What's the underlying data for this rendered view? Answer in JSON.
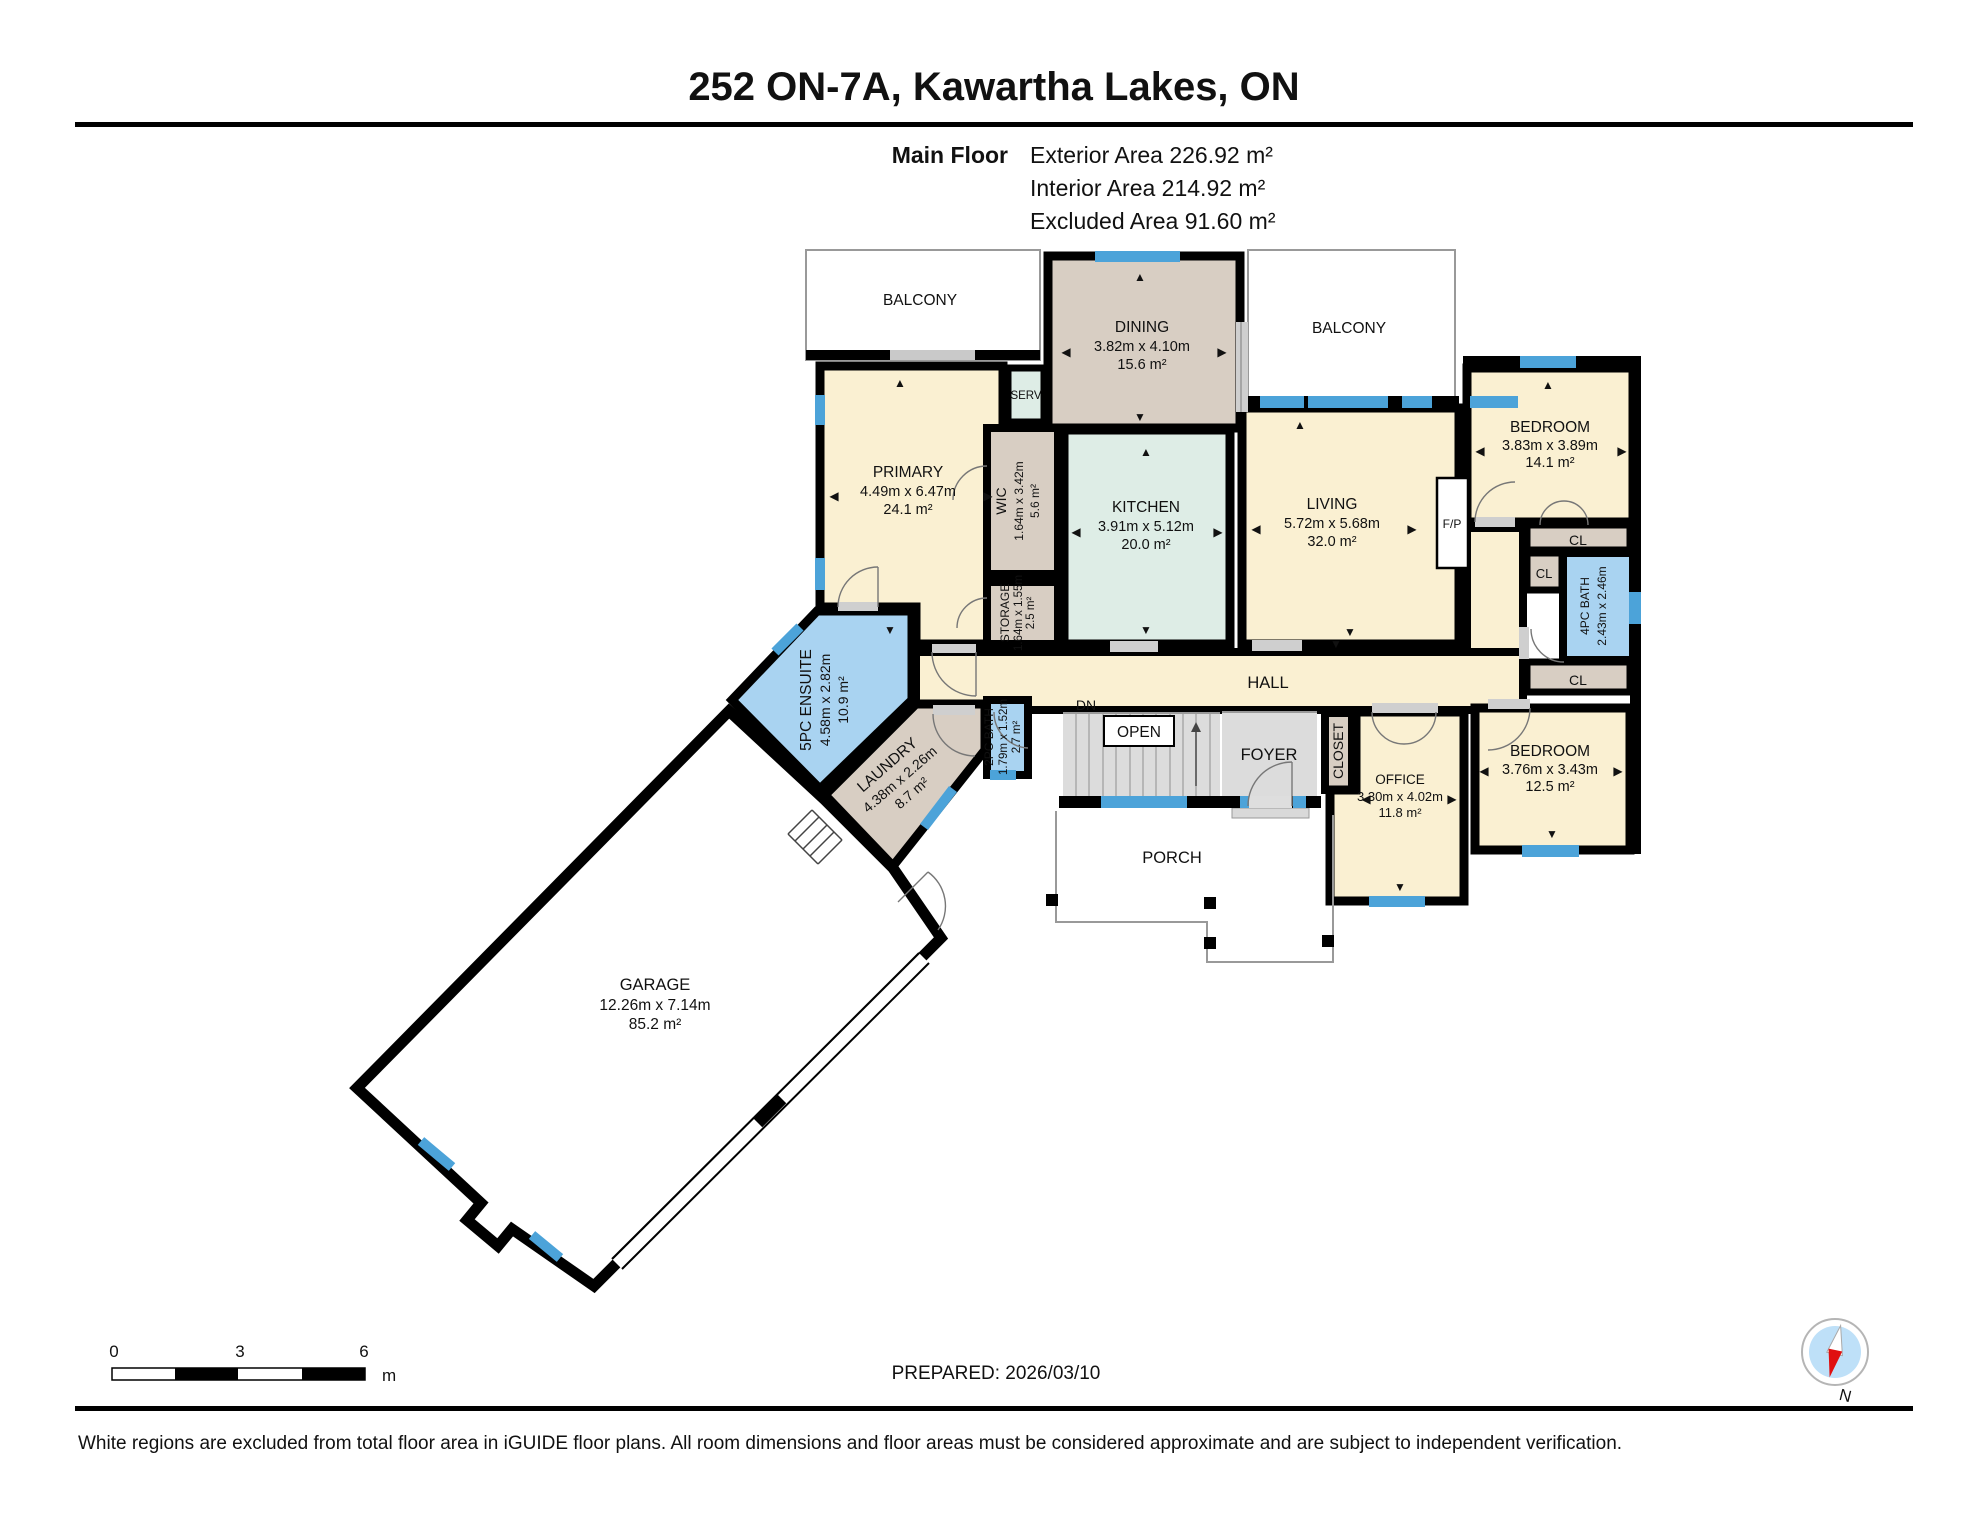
{
  "header": {
    "title": "252 ON-7A, Kawartha Lakes, ON",
    "floor_label": "Main Floor",
    "stats": {
      "exterior": "Exterior Area 226.92 m²",
      "interior": "Interior Area 214.92 m²",
      "excluded": "Excluded Area 91.60 m²"
    }
  },
  "rooms": {
    "balcony1": {
      "name": "BALCONY"
    },
    "balcony2": {
      "name": "BALCONY"
    },
    "dining": {
      "name": "DINING",
      "dims": "3.82m x 4.10m",
      "area": "15.6 m²"
    },
    "bedroom_tr": {
      "name": "BEDROOM",
      "dims": "3.83m x 3.89m",
      "area": "14.1 m²"
    },
    "primary": {
      "name": "PRIMARY",
      "dims": "4.49m x 6.47m",
      "area": "24.1 m²"
    },
    "serv": {
      "name": "SERV"
    },
    "wic": {
      "name": "WIC",
      "dims": "1.64m x 3.42m",
      "area": "5.6 m²"
    },
    "storage": {
      "name": "STORAGE",
      "dims": "1.64m x 1.55m",
      "area": "2.5 m²"
    },
    "kitchen": {
      "name": "KITCHEN",
      "dims": "3.91m x 5.12m",
      "area": "20.0 m²"
    },
    "living": {
      "name": "LIVING",
      "dims": "5.72m x 5.68m",
      "area": "32.0 m²"
    },
    "fp": {
      "name": "F/P"
    },
    "hall": {
      "name": "HALL"
    },
    "dn": {
      "name": "DN"
    },
    "open": {
      "name": "OPEN"
    },
    "foyer": {
      "name": "FOYER"
    },
    "closet": {
      "name": "CLOSET"
    },
    "office": {
      "name": "OFFICE",
      "dims": "3.30m x 4.02m",
      "area": "11.8 m²"
    },
    "bedroom_br": {
      "name": "BEDROOM",
      "dims": "3.76m x 3.43m",
      "area": "12.5 m²"
    },
    "porch": {
      "name": "PORCH"
    },
    "ensuite": {
      "name": "5PC ENSUITE",
      "dims": "4.58m x 2.82m",
      "area": "10.9 m²"
    },
    "laundry": {
      "name": "LAUNDRY",
      "dims": "4.38m x 2.26m",
      "area": "8.7 m²"
    },
    "bath2": {
      "name": "2PC BATH",
      "dims": "1.79m x 1.52m",
      "area": "2.7 m²"
    },
    "bath4": {
      "name": "4PC BATH",
      "dims": "2.43m x 2.46m"
    },
    "cl1": {
      "name": "CL"
    },
    "cl2": {
      "name": "CL"
    },
    "cl3": {
      "name": "CL"
    },
    "garage": {
      "name": "GARAGE",
      "dims": "12.26m x 7.14m",
      "area": "85.2 m²"
    }
  },
  "footer": {
    "scale": {
      "start": "0",
      "mid": "3",
      "end": "6",
      "unit": "m"
    },
    "prepared": "PREPARED: 2026/03/10",
    "compass_label": "N",
    "disclaimer": "White regions are excluded from total floor area in iGUIDE floor plans. All room dimensions and floor areas must be considered approximate and are subject to independent verification."
  },
  "glyphs": {
    "up": "▲",
    "down": "▼",
    "left": "◀",
    "right": "▶"
  },
  "colors": {
    "room_yellow": "#FAF0D2",
    "room_tan": "#D8CEC3",
    "room_mint": "#DEEDE6",
    "room_blue": "#A9D3F1",
    "room_gray": "#DCDCDC",
    "window_blue": "#4CA3D9",
    "wall_black": "#000000",
    "compass_red": "#E01010"
  },
  "decorations": {
    "dim_arrows": [
      {
        "glyph": "left",
        "x": 1066,
        "y": 356
      },
      {
        "glyph": "right",
        "x": 1222,
        "y": 356
      },
      {
        "glyph": "up",
        "x": 1140,
        "y": 281
      },
      {
        "glyph": "down",
        "x": 1140,
        "y": 421
      },
      {
        "glyph": "left",
        "x": 1076,
        "y": 536
      },
      {
        "glyph": "right",
        "x": 1218,
        "y": 536
      },
      {
        "glyph": "up",
        "x": 1146,
        "y": 456
      },
      {
        "glyph": "down",
        "x": 1146,
        "y": 634
      },
      {
        "glyph": "left",
        "x": 1256,
        "y": 533
      },
      {
        "glyph": "right",
        "x": 1412,
        "y": 533
      },
      {
        "glyph": "up",
        "x": 1300,
        "y": 429
      },
      {
        "glyph": "down",
        "x": 1350,
        "y": 636
      },
      {
        "glyph": "left",
        "x": 834,
        "y": 500
      },
      {
        "glyph": "right",
        "x": 988,
        "y": 500
      },
      {
        "glyph": "up",
        "x": 900,
        "y": 387
      },
      {
        "glyph": "down",
        "x": 890,
        "y": 634
      },
      {
        "glyph": "left",
        "x": 1480,
        "y": 455
      },
      {
        "glyph": "right",
        "x": 1622,
        "y": 455
      },
      {
        "glyph": "up",
        "x": 1548,
        "y": 389
      },
      {
        "glyph": "left",
        "x": 1484,
        "y": 775
      },
      {
        "glyph": "right",
        "x": 1618,
        "y": 775
      },
      {
        "glyph": "down",
        "x": 1552,
        "y": 838
      },
      {
        "glyph": "left",
        "x": 1366,
        "y": 803
      },
      {
        "glyph": "right",
        "x": 1452,
        "y": 803
      },
      {
        "glyph": "down",
        "x": 1400,
        "y": 891
      },
      {
        "glyph": "down",
        "x": 1336,
        "y": 648
      }
    ]
  }
}
